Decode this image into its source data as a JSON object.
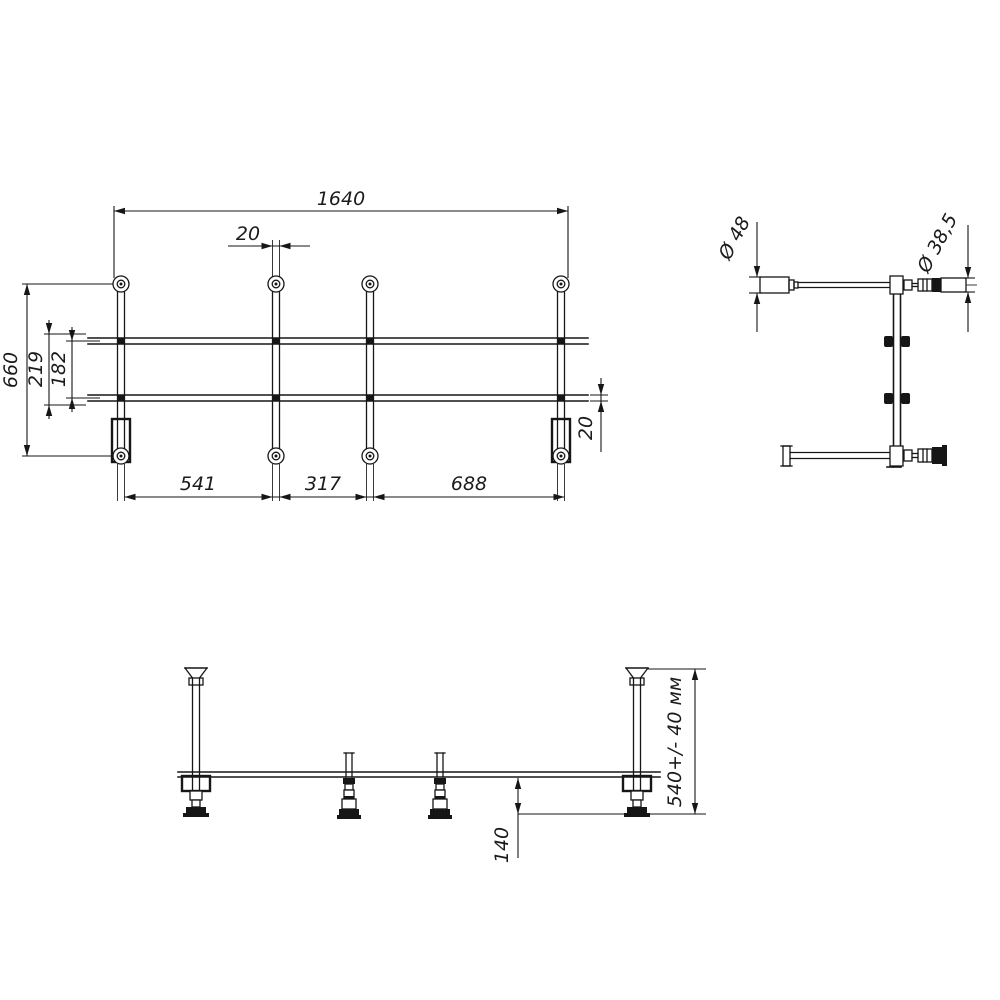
{
  "drawing": {
    "background_color": "#ffffff",
    "line_color": "#161616",
    "plan_view": {
      "dim_total_length": "1640",
      "dim_tube_width": "20",
      "dim_total_width": "660",
      "dim_rail_outer_spacing": "219",
      "dim_rail_inner_spacing": "182",
      "dim_span_left": "541",
      "dim_span_middle": "317",
      "dim_span_right": "688",
      "dim_rail_width": "20"
    },
    "side_view": {
      "dim_cup_diameter": "Ø 48",
      "dim_leg_diameter": "Ø 38,5"
    },
    "front_view": {
      "dim_frame_height": "540+/- 40 мм",
      "dim_foot_clearance": "140"
    }
  }
}
